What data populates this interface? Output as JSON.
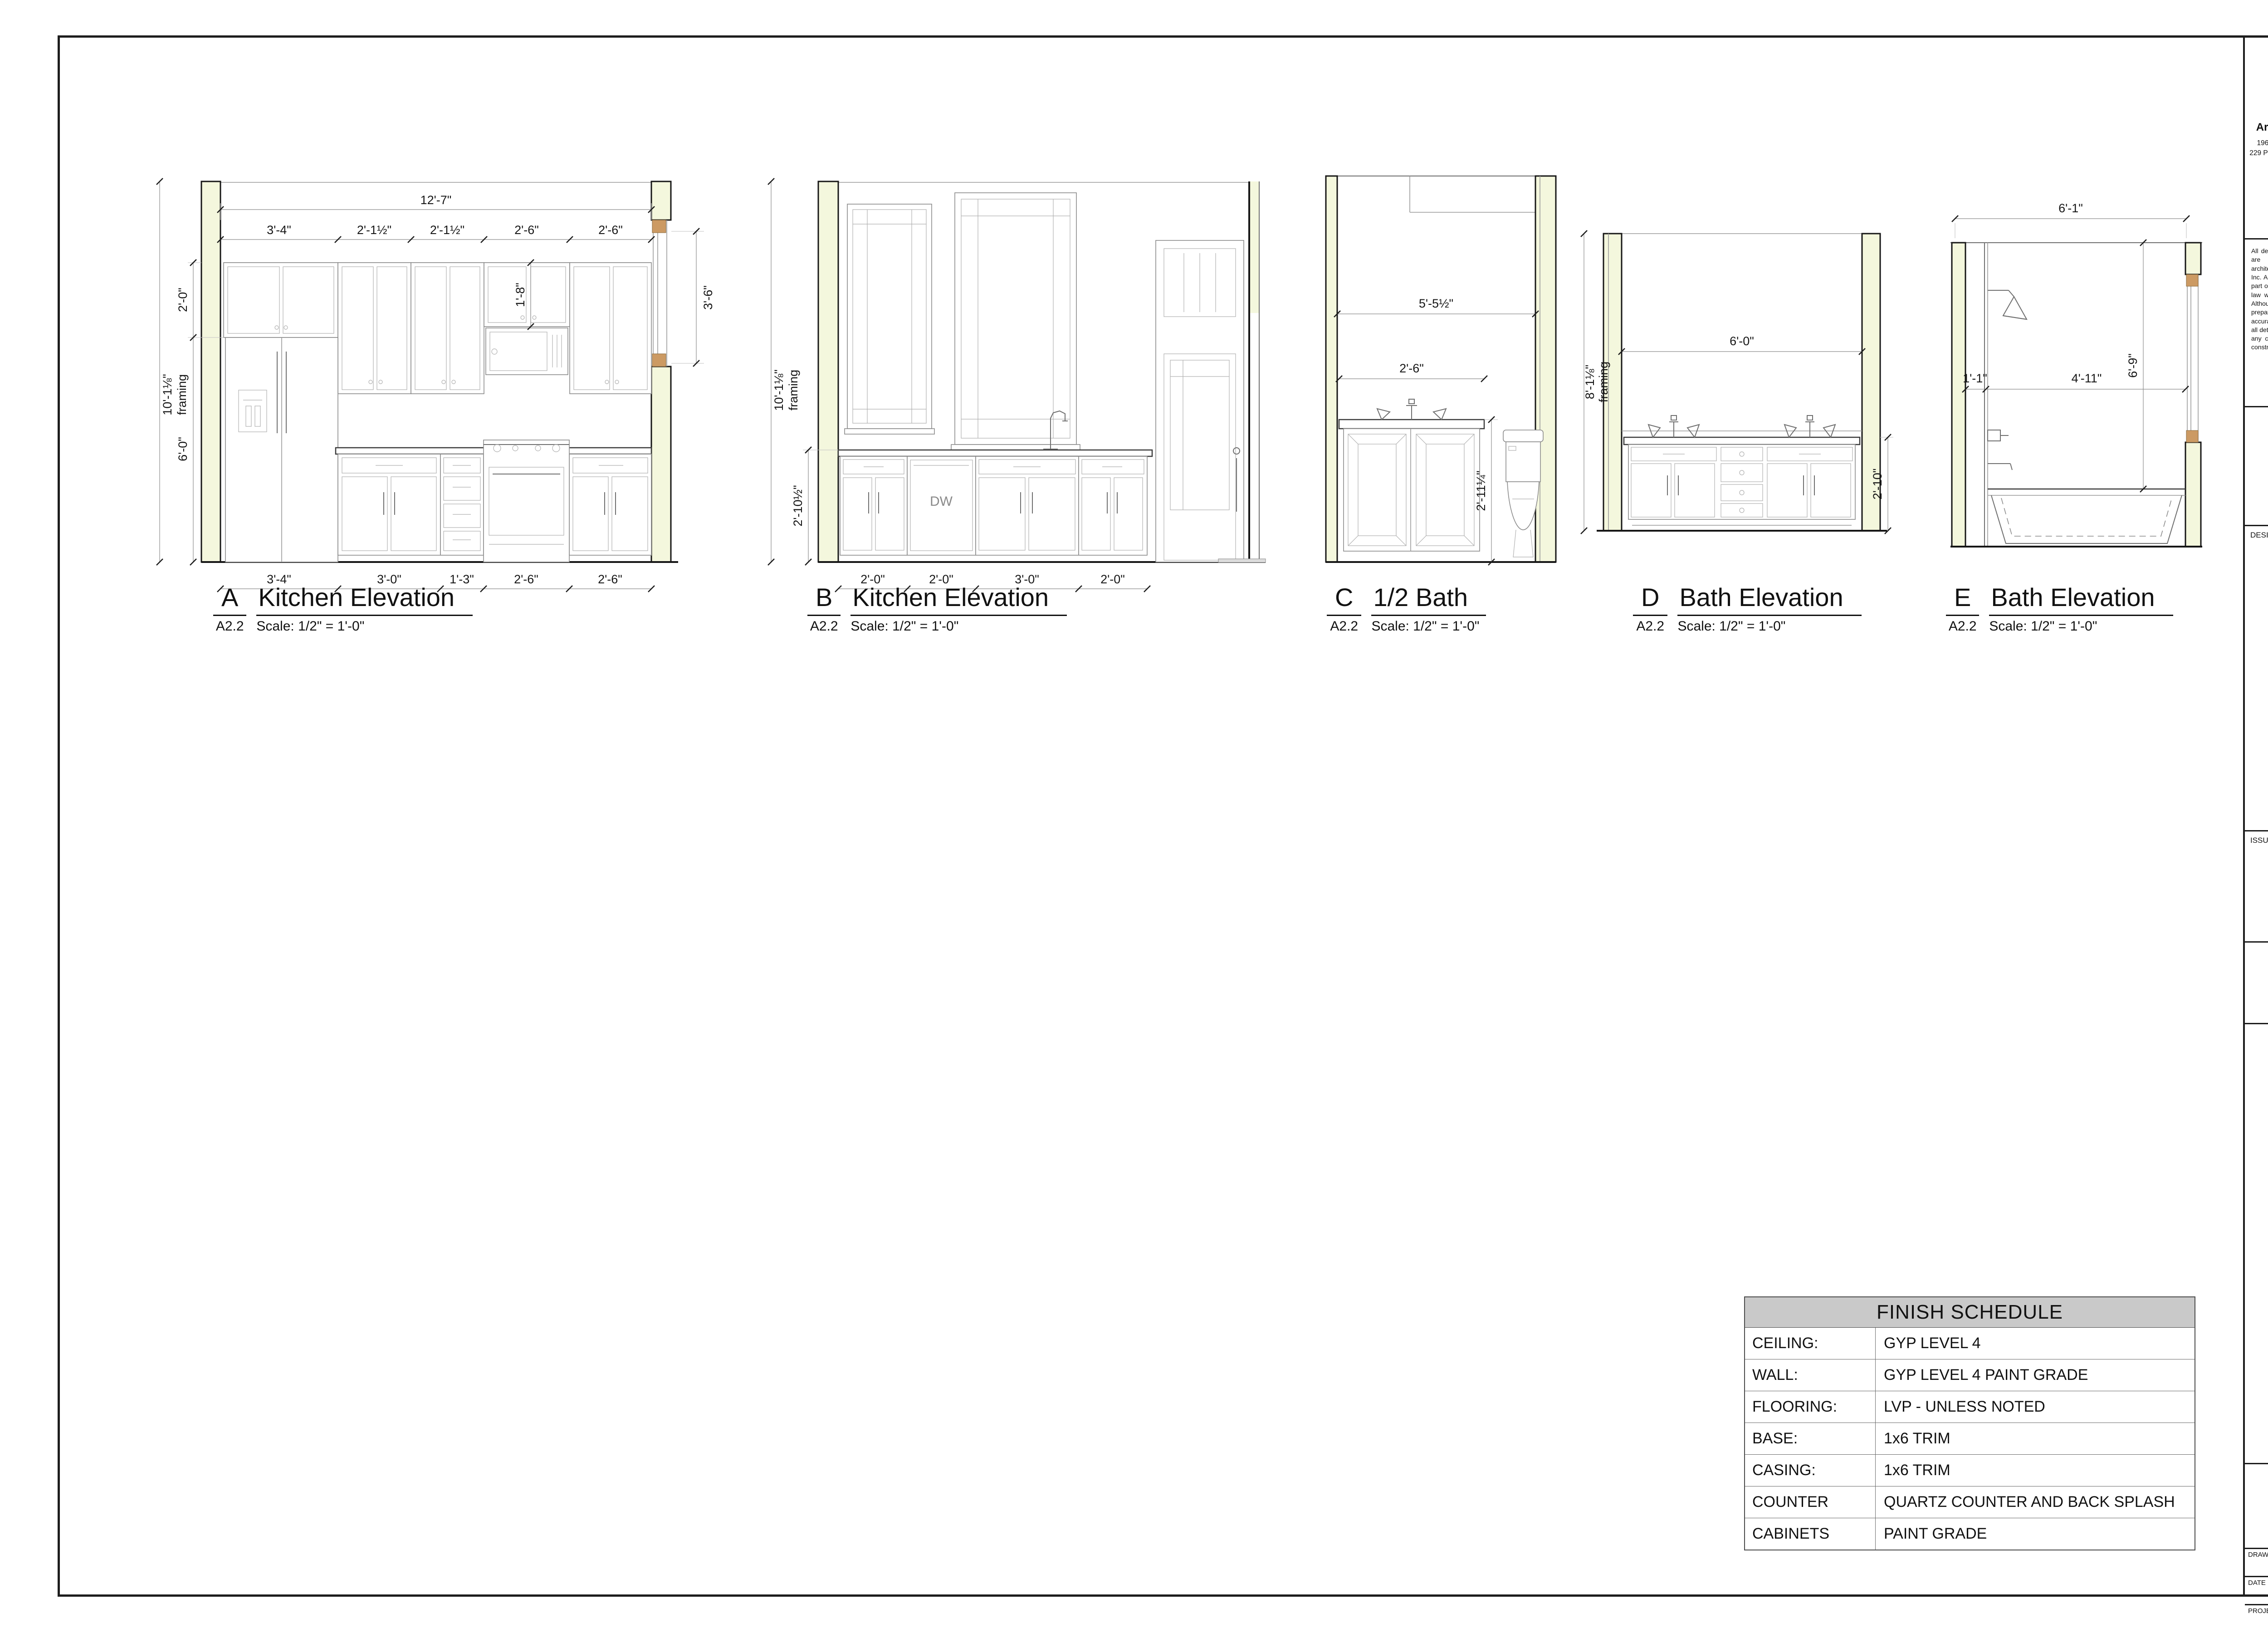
{
  "drawings": {
    "a": {
      "letter": "A",
      "title": "Kitchen Elevation",
      "ref": "A2.2",
      "scale": "Scale: 1/2\" = 1'-0\"",
      "dims": {
        "overall": "12'-7\"",
        "upper": [
          "3'-4\"",
          "2'-1½\"",
          "2'-1½\"",
          "2'-6\"",
          "2'-6\""
        ],
        "bottom": [
          "3'-4\"",
          "3'-0\"",
          "1'-3\"",
          "2'-6\"",
          "2'-6\""
        ],
        "left_upper": "2'-0\"",
        "left_lower": "6'-0\"",
        "wall_height": "10'-1⅛\"",
        "framing": "framing",
        "micro": "1'-8\"",
        "window": "3'-6\""
      }
    },
    "b": {
      "letter": "B",
      "title": "Kitchen Elevation",
      "ref": "A2.2",
      "scale": "Scale: 1/2\" = 1'-0\"",
      "dims": {
        "wall_height": "10'-1⅛\"",
        "framing": "framing",
        "counter_height": "2'-10½\"",
        "bottom": [
          "2'-0\"",
          "2'-0\"",
          "3'-0\"",
          "2'-0\""
        ],
        "dw": "DW"
      }
    },
    "c": {
      "letter": "C",
      "title": "1/2 Bath",
      "ref": "A2.2",
      "scale": "Scale: 1/2\" = 1'-0\"",
      "dims": {
        "width": "5'-5½\"",
        "vanity": "2'-6\"",
        "height": "2'-11¼\""
      }
    },
    "d": {
      "letter": "D",
      "title": "Bath Elevation",
      "ref": "A2.2",
      "scale": "Scale: 1/2\" = 1'-0\"",
      "dims": {
        "wall_height": "8'-1⅛\"",
        "framing": "framing",
        "width": "6'-0\"",
        "counter_height": "2'-10\""
      }
    },
    "e": {
      "letter": "E",
      "title": "Bath Elevation",
      "ref": "A2.2",
      "scale": "Scale: 1/2\" = 1'-0\"",
      "dims": {
        "overall": "6'-1\"",
        "left": "1'-1\"",
        "mid": "4'-11\"",
        "height": "6'-9\""
      }
    }
  },
  "finish_schedule": {
    "title": "FINISH SCHEDULE",
    "rows": [
      {
        "label": "CEILING:",
        "value": "GYP LEVEL 4"
      },
      {
        "label": "WALL:",
        "value": "GYP LEVEL 4 PAINT GRADE"
      },
      {
        "label": "FLOORING:",
        "value": "LVP - UNLESS NOTED"
      },
      {
        "label": "BASE:",
        "value": "1x6 TRIM"
      },
      {
        "label": "CASING:",
        "value": "1x6 TRIM"
      },
      {
        "label": "COUNTER",
        "value": "QUARTZ COUNTER AND BACK SPLASH"
      },
      {
        "label": "CABINETS",
        "value": "PAINT GRADE"
      }
    ]
  },
  "title_block": {
    "firm": {
      "name": "Architectural Overflow, LLC",
      "address1": "1964 W Wayzata Blvd, Long Lake, MN 55356",
      "address2": "229 Peachtree St NE, Ste 1008 Atlanta, GA 30303",
      "phone": "(952) 960-8212",
      "website": "www.architecturaloverflow.com"
    },
    "disclaimer": "All designs and plans contained in these documents are the original work and property of the architect/designer indicated below or Opticos Design Inc. Any reuse or reproduction of these documents in part or whole is strictly prohibited by federal copyright law without prior consent from Opticos Design Inc. Although every effort has been made in designing and preparing these plans and reviewing them for accuracy, the installer, owner or contractor must check all details and dimensions and shall be responsible for any changes or adjustments required during actual construction.",
    "copyright": "© 2024 Opticos Design Inc.",
    "design_architect_label": "DESIGN ARCHITECT:",
    "architect": {
      "logo_text": "OPTICOS",
      "name": "Opticos Design, Inc.",
      "address1": "2100 Milvia St, Ste 125",
      "address2": "Berkeley,CA 94704",
      "website": "opticosdesign.com"
    },
    "issue_label": "ISSUE:",
    "stamp_line1": "PRELIMINARY -",
    "stamp_line2": "NOT FOR",
    "stamp_line3": "CONSTRUCTION",
    "project": {
      "line1": "West Village",
      "line2": "CY UNIT-3",
      "location": "Florence, Alabama"
    },
    "sheet_title": "Interior Elevations",
    "drawing_by_label": "DRAWING BY",
    "drawing_by": "GC",
    "date_label": "DATE",
    "date": "11/3/24",
    "project_number_label": "PROJECT NUMBER",
    "project_number": "PRJ - 342",
    "sheet_number": "A2.2"
  },
  "colors": {
    "logo_green": "#b4cc33",
    "logo_yellow": "#efc53f",
    "insulation": "#f4f7dd",
    "wood": "#cc9a63",
    "header_gray": "#c9c9c9"
  }
}
